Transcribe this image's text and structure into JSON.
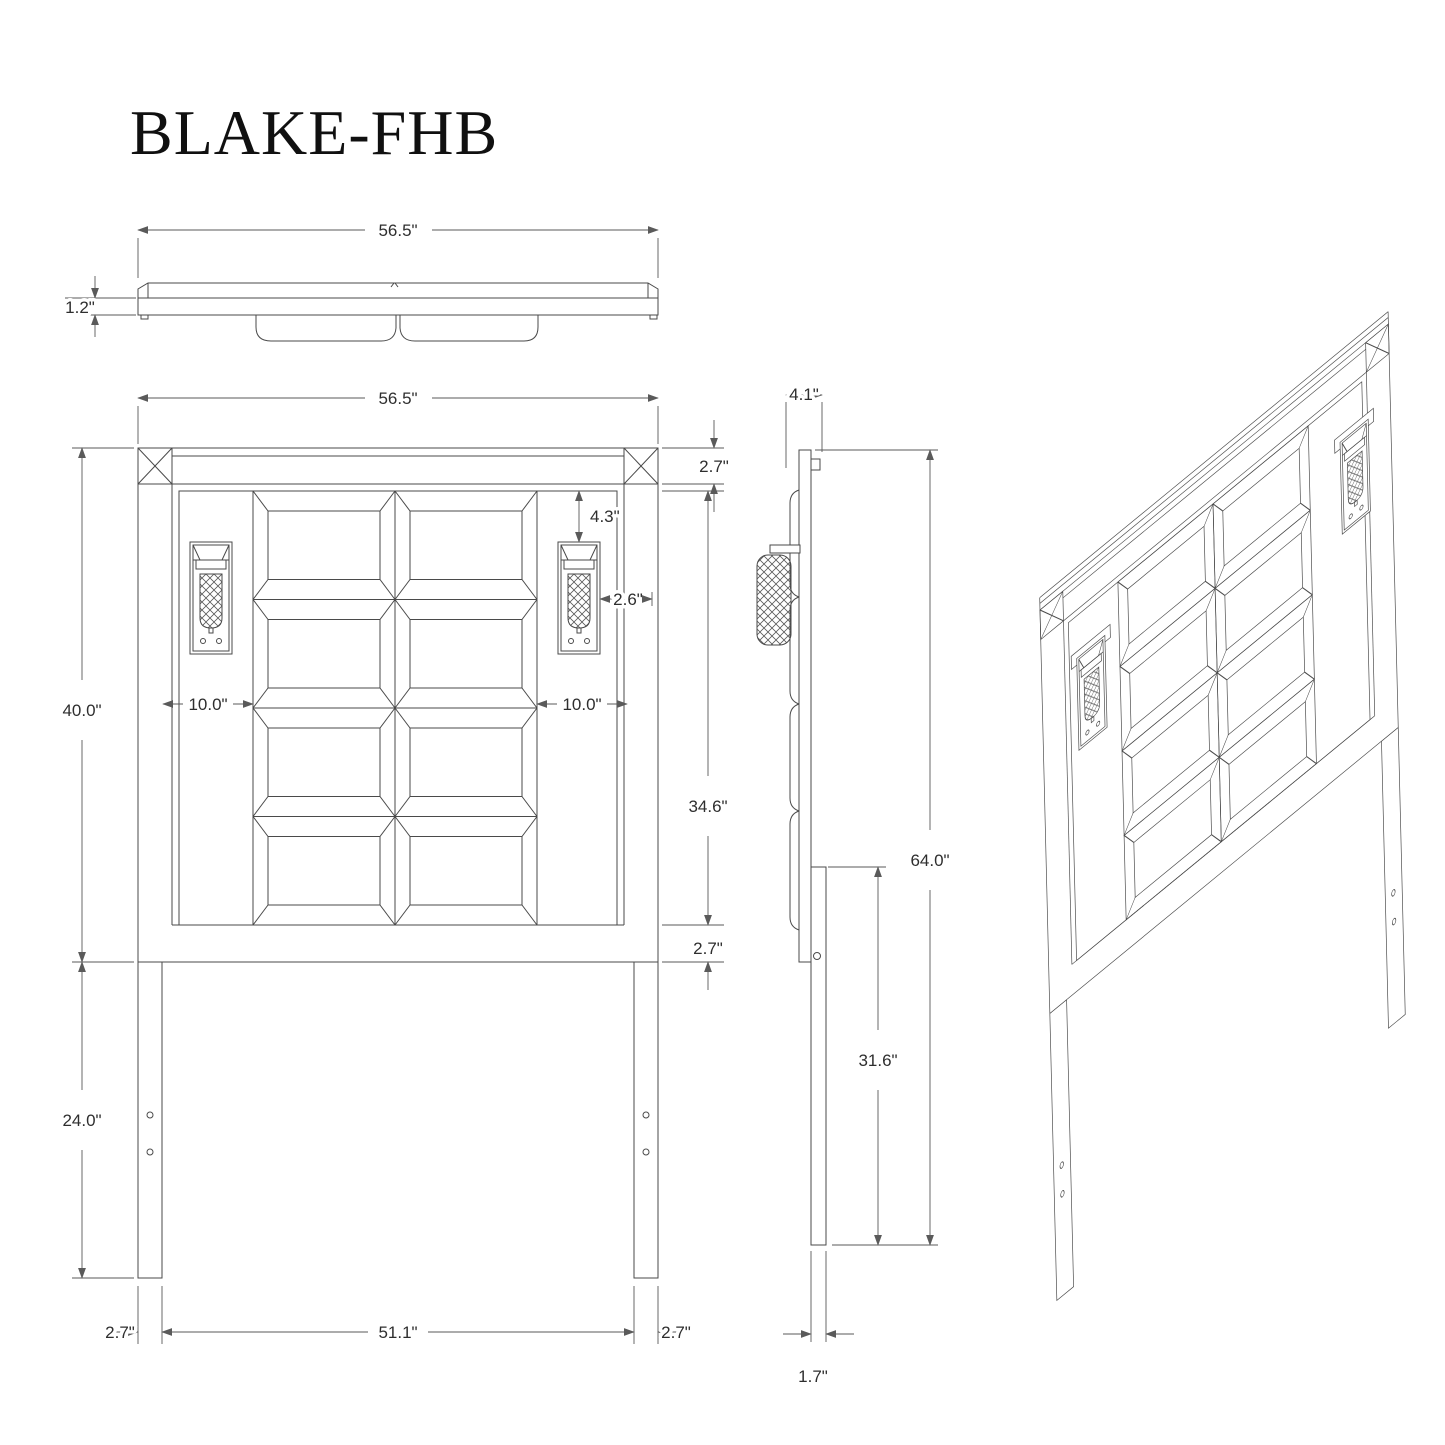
{
  "title": "BLAKE-FHB",
  "views": {
    "top": {
      "width": "56.5\"",
      "panel_thickness": "1.2\""
    },
    "front": {
      "width": "56.5\"",
      "top_rail_height": "2.7\"",
      "sconce_top_offset": "4.3\"",
      "sconce_width": "2.6\"",
      "panel_inset_left": "10.0\"",
      "panel_inset_right": "10.0\"",
      "panel_field_height": "34.6\"",
      "bottom_rail_height": "2.7\"",
      "headboard_height": "40.0\"",
      "leg_length": "24.0\"",
      "left_leg_width": "2.7\"",
      "inner_span": "51.1\"",
      "right_leg_width": "2.7\""
    },
    "side": {
      "depth": "4.1\"",
      "overall_height": "64.0\"",
      "leg_length": "31.6\"",
      "leg_depth": "1.7\""
    }
  }
}
